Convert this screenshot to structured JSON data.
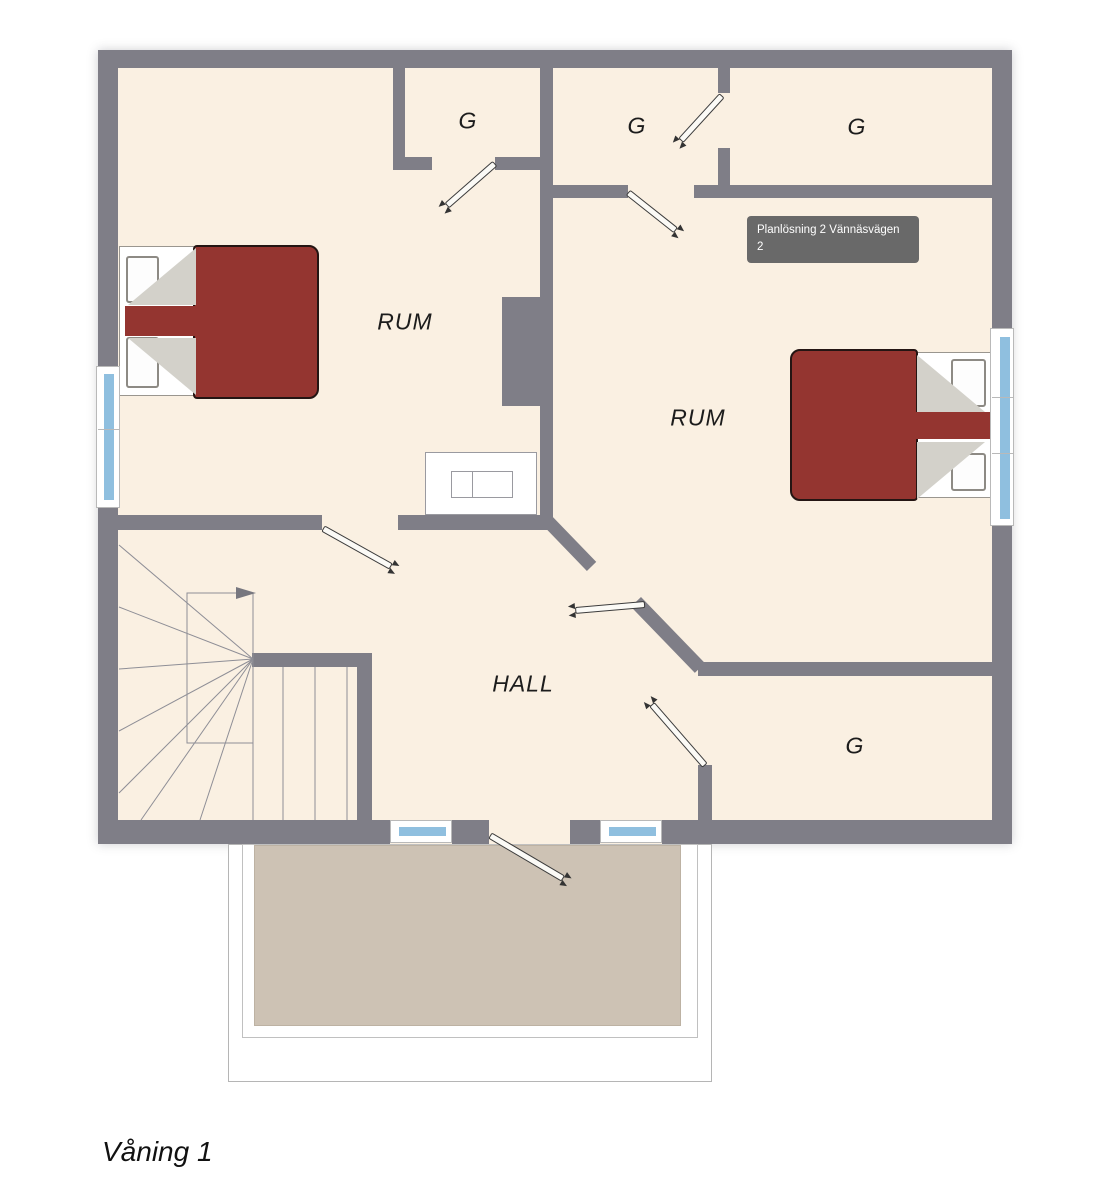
{
  "floor_plan": {
    "caption": "Våning 1",
    "tooltip": {
      "text": "Planlösning 2 Vännäsvägen 2"
    },
    "rooms": {
      "room_left": "RUM",
      "room_right": "RUM",
      "hall": "HALL",
      "closet_top_left": "G",
      "closet_top_mid": "G",
      "closet_top_right": "G",
      "closet_bottom_right": "G"
    },
    "colors": {
      "floor": "#faf0e2",
      "wall": "#7f7e87",
      "window_blue": "#8fbfdf",
      "bed_red": "#943530",
      "fold_gray": "#d3d1ca",
      "deck": "#cdc2b4",
      "tooltip_bg": "#696969"
    }
  }
}
